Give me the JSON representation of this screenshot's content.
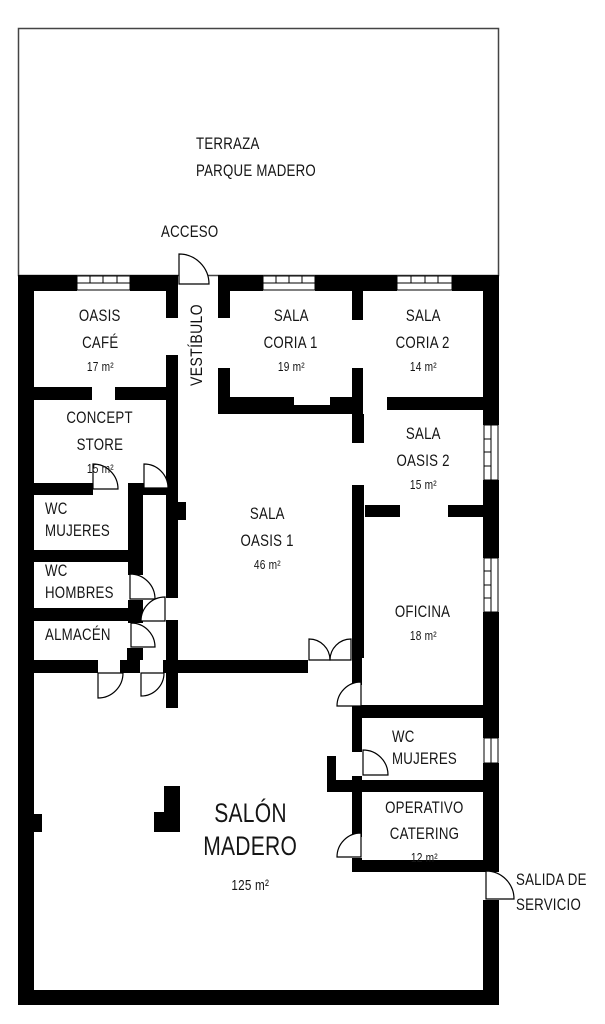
{
  "plan": {
    "terraza": {
      "line1": "TERRAZA",
      "line2": "PARQUE MADERO"
    },
    "acceso": "ACCESO",
    "vestibulo": "VESTÍBULO",
    "salida": {
      "line1": "SALIDA DE",
      "line2": "SERVICIO"
    },
    "rooms": {
      "oasis_cafe": {
        "line1": "OASIS",
        "line2": "CAFÉ",
        "area": "17 m²"
      },
      "sala_coria_1": {
        "line1": "SALA",
        "line2": "CORIA 1",
        "area": "19 m²"
      },
      "sala_coria_2": {
        "line1": "SALA",
        "line2": "CORIA 2",
        "area": "14 m²"
      },
      "concept_store": {
        "line1": "CONCEPT",
        "line2": "STORE",
        "area": "15 m²"
      },
      "sala_oasis_2": {
        "line1": "SALA",
        "line2": "OASIS 2",
        "area": "15 m²"
      },
      "wc_mujeres_left": {
        "line1": "WC",
        "line2": "MUJERES"
      },
      "sala_oasis_1": {
        "line1": "SALA",
        "line2": "OASIS 1",
        "area": "46 m²"
      },
      "wc_hombres": {
        "line1": "WC",
        "line2": "HOMBRES"
      },
      "oficina": {
        "line1": "OFICINA",
        "area": "18 m²"
      },
      "almacen": {
        "line1": "ALMACÉN"
      },
      "wc_mujeres_right": {
        "line1": "WC",
        "line2": "MUJERES"
      },
      "operativo_catering": {
        "line1": "OPERATIVO",
        "line2": "CATERING",
        "area": "12 m²"
      },
      "salon_madero": {
        "line1": "SALÓN",
        "line2": "MADERO",
        "area": "125 m²"
      }
    },
    "colors": {
      "wall": "#000000",
      "background": "#ffffff",
      "text": "#151515"
    }
  }
}
